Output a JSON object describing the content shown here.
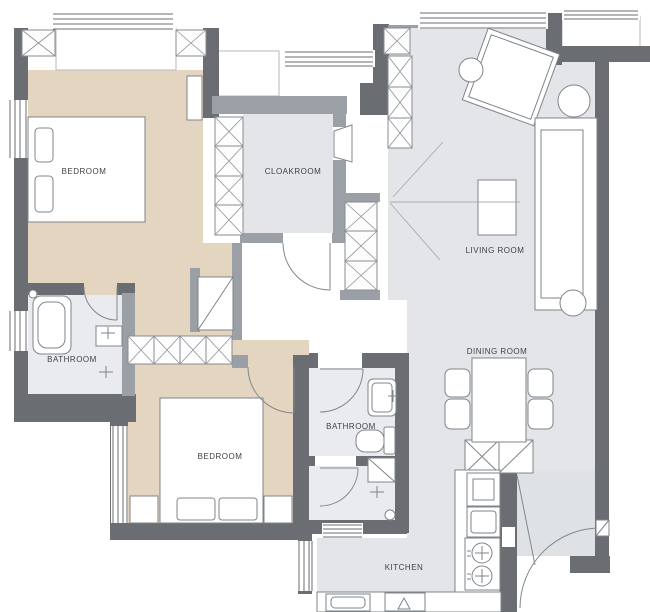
{
  "colors": {
    "wall_dark": "#6a6e72",
    "wall_mid": "#9aa0a5",
    "floor_beige": "#e4d5c0",
    "floor_gray": "#e3e5e8",
    "floor_light": "#e9ebee",
    "floor_balcony": "#dfe2e5",
    "furniture_stroke": "#7f848a",
    "line": "#8d9297",
    "text": "#3d4248"
  },
  "rooms": {
    "bedroom_1": {
      "label": "BEDROOM"
    },
    "cloakroom": {
      "label": "CLOAKROOM"
    },
    "living_room": {
      "label": "LIVING ROOM"
    },
    "bathroom_1": {
      "label": "BATHROOM"
    },
    "bedroom_2": {
      "label": "BEDROOM"
    },
    "bathroom_2": {
      "label": "BATHROOM"
    },
    "dining_room": {
      "label": "DINING ROOM"
    },
    "kitchen": {
      "label": "KITCHEN"
    }
  }
}
